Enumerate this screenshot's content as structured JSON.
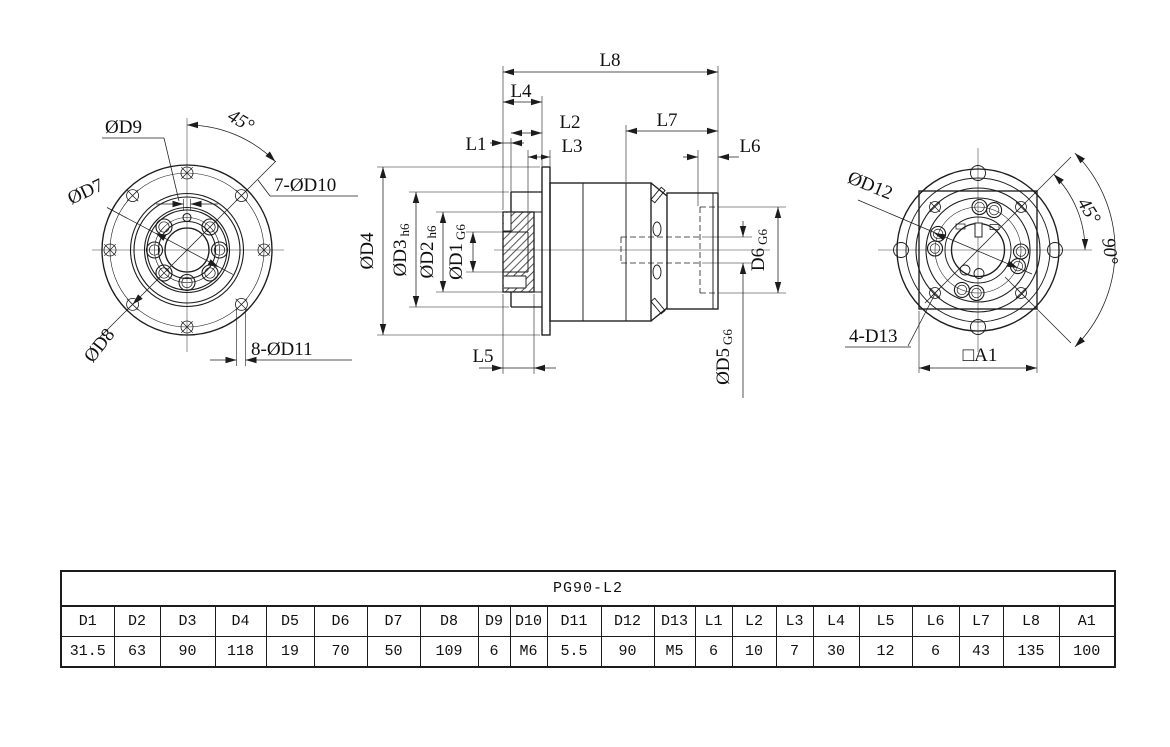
{
  "front_view": {
    "labels": {
      "d9": "ØD9",
      "angle45": "45°",
      "d7": "ØD7",
      "d10": "7-ØD10",
      "d8": "ØD8",
      "d11": "8-ØD11"
    }
  },
  "section_view": {
    "labels": {
      "l8": "L8",
      "l4": "L4",
      "l1": "L1",
      "l2": "L2",
      "l3": "L3",
      "l7": "L7",
      "l6": "L6",
      "l5": "L5",
      "d4": "ØD4",
      "d3": "ØD3",
      "d3_tol": "h6",
      "d2": "ØD2",
      "d2_tol": "h6",
      "d1": "ØD1",
      "d1_tol": "G6",
      "d6": "D6",
      "d6_tol": "G6",
      "d5": "ØD5",
      "d5_tol": "G6"
    }
  },
  "rear_view": {
    "labels": {
      "d12": "ØD12",
      "angle45": "45°",
      "angle90": "90°",
      "d13": "4-D13",
      "a1": "□A1"
    }
  },
  "table": {
    "title": "PG90-L2",
    "headers": [
      "D1",
      "D2",
      "D3",
      "D4",
      "D5",
      "D6",
      "D7",
      "D8",
      "D9",
      "D10",
      "D11",
      "D12",
      "D13",
      "L1",
      "L2",
      "L3",
      "L4",
      "L5",
      "L6",
      "L7",
      "L8",
      "A1"
    ],
    "values": [
      "31.5",
      "63",
      "90",
      "118",
      "19",
      "70",
      "50",
      "109",
      "6",
      "M6",
      "5.5",
      "90",
      "M5",
      "6",
      "10",
      "7",
      "30",
      "12",
      "6",
      "43",
      "135",
      "100"
    ]
  }
}
